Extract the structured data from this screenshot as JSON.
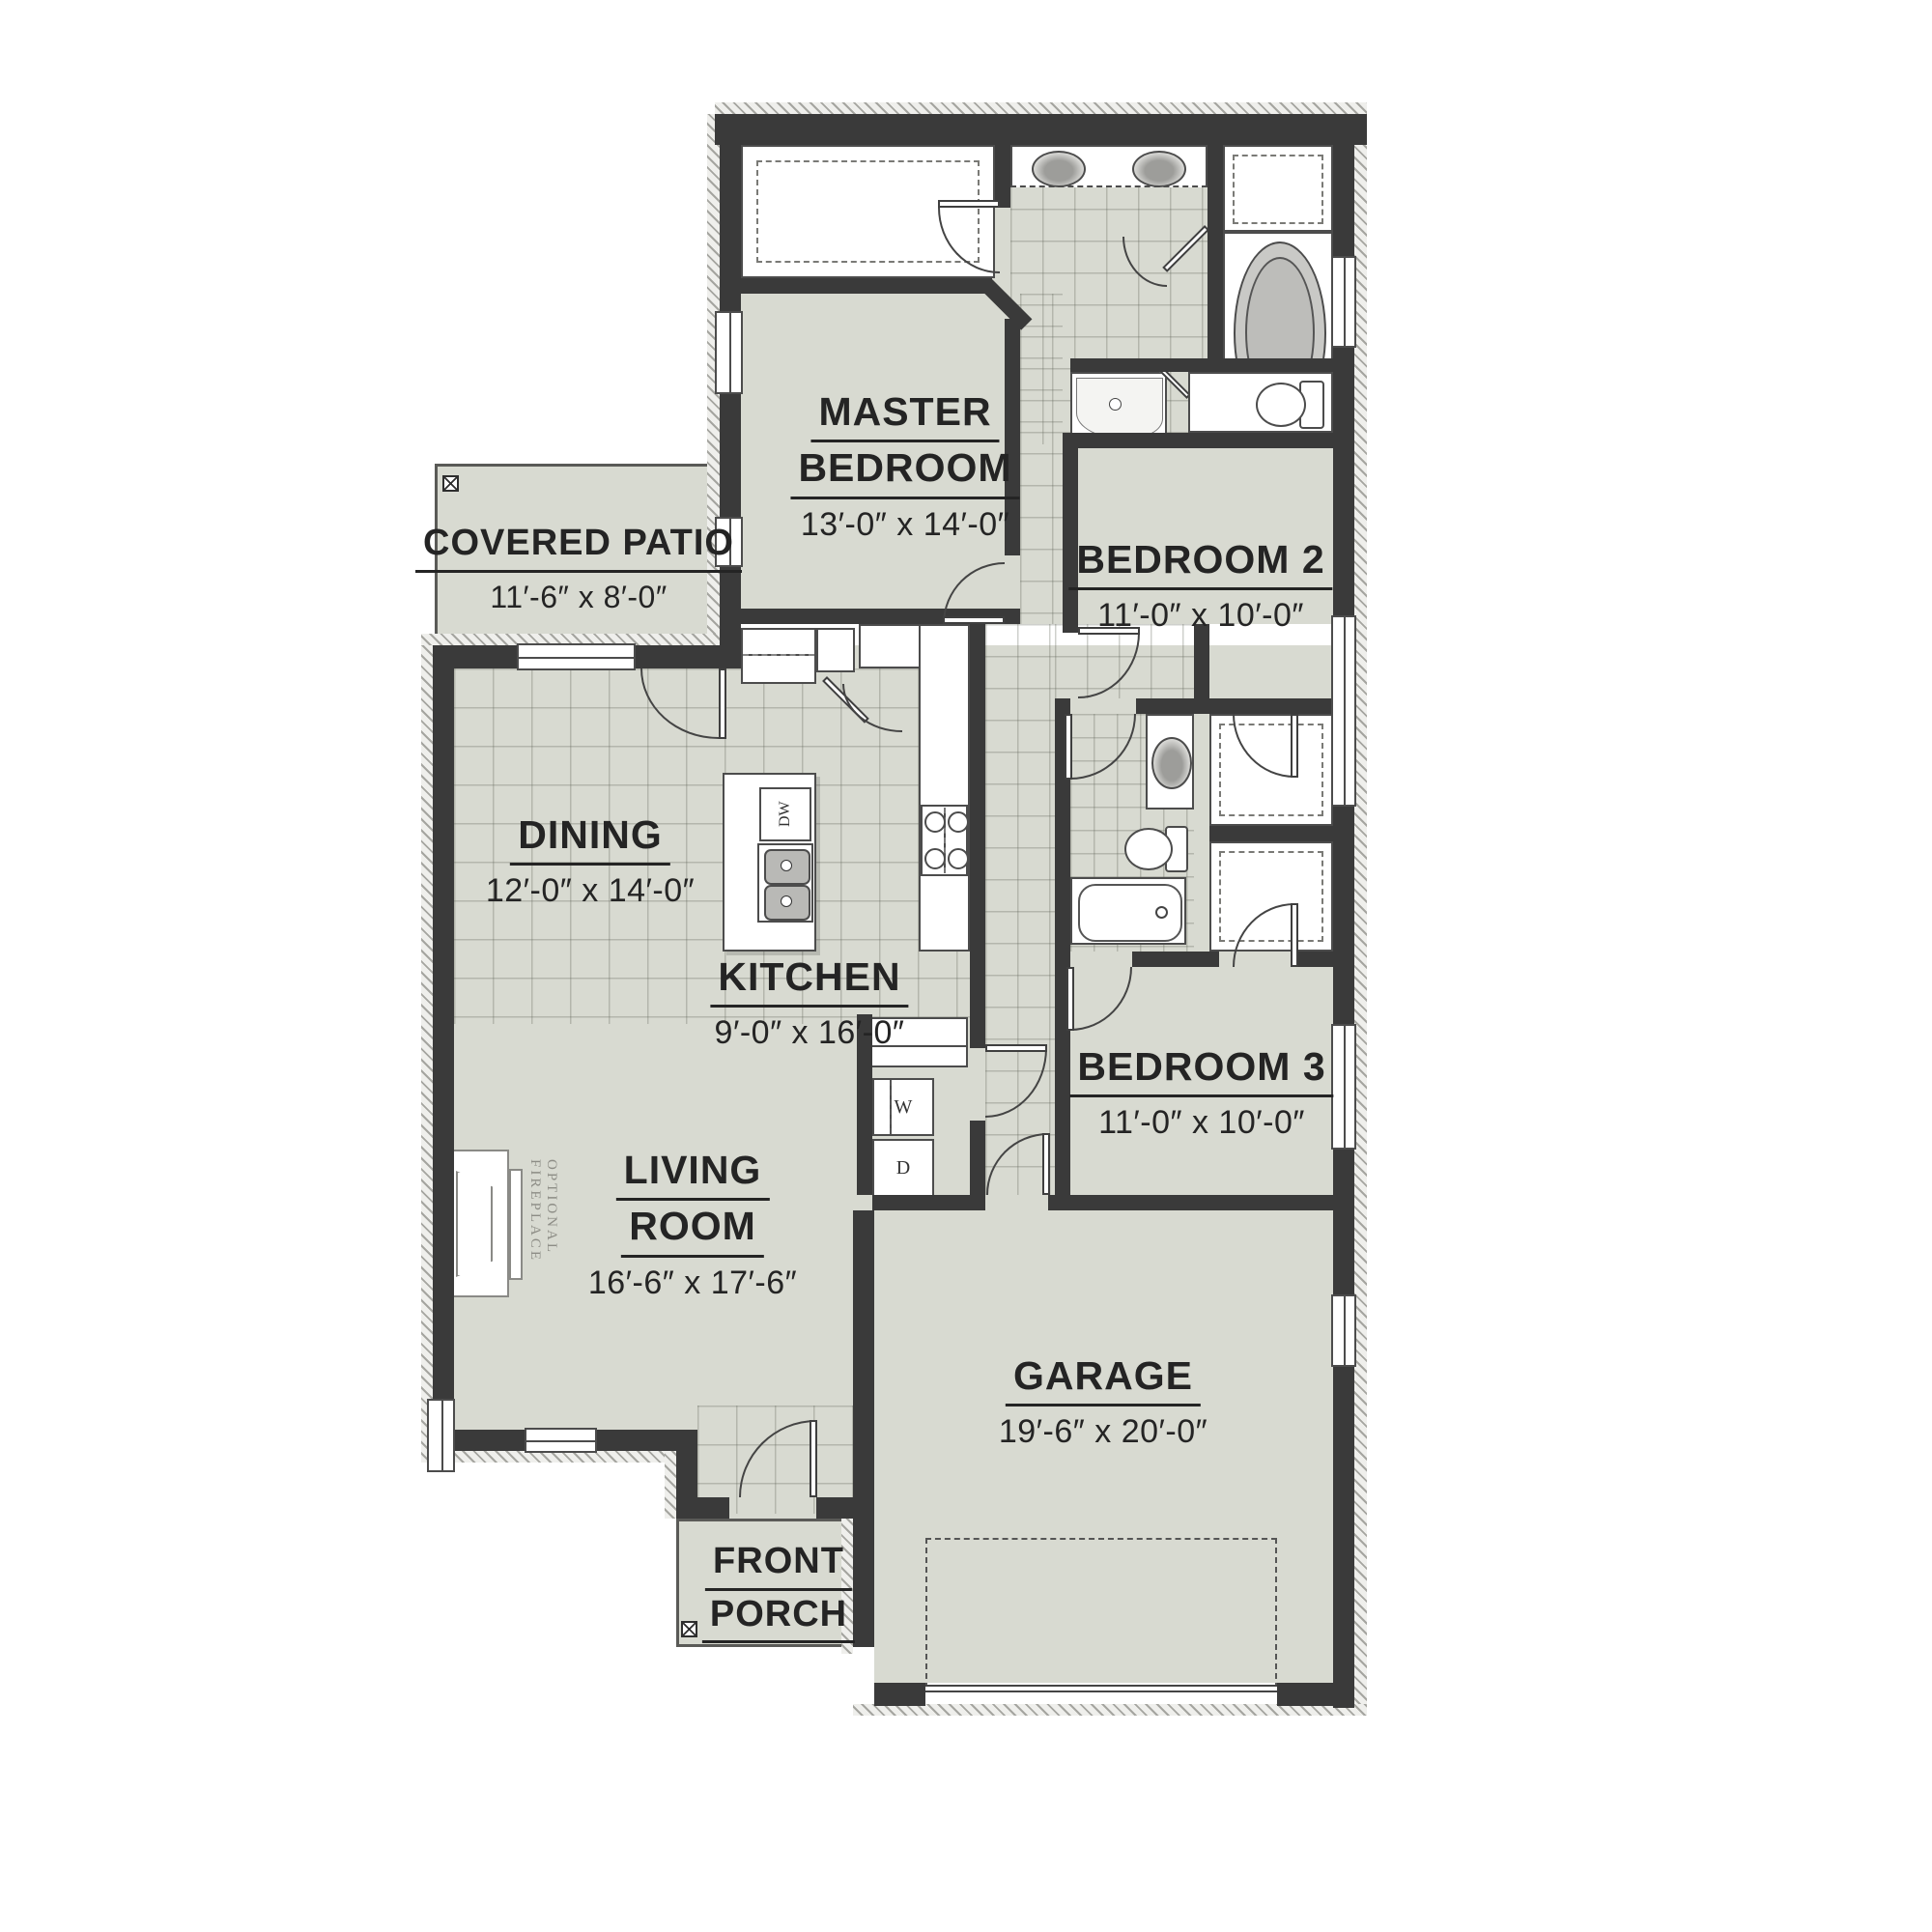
{
  "plan_title": "Single-story house floor plan",
  "colors": {
    "wall": "#3a3a3a",
    "floor": "#d8dad1",
    "fixture_white": "#ffffff",
    "text": "#242424",
    "hatch_line": "#a5a5a0"
  },
  "rooms": {
    "master": {
      "name_line1": "MASTER",
      "name_line2": "BEDROOM",
      "dims": "13′-0″ x 14′-0″"
    },
    "bedroom2": {
      "name": "BEDROOM 2",
      "dims": "11′-0″ x 10′-0″"
    },
    "bedroom3": {
      "name": "BEDROOM 3",
      "dims": "11′-0″ x 10′-0″"
    },
    "covered_patio": {
      "name": "COVERED PATIO",
      "dims": "11′-6″ x 8′-0″"
    },
    "dining": {
      "name": "DINING",
      "dims": "12′-0″ x 14′-0″"
    },
    "kitchen": {
      "name": "KITCHEN",
      "dims": "9′-0″ x 16′-0″"
    },
    "living": {
      "name_line1": "LIVING",
      "name_line2": "ROOM",
      "dims": "16′-6″ x 17′-6″"
    },
    "garage": {
      "name": "GARAGE",
      "dims": "19′-6″ x 20′-0″"
    },
    "front_porch": {
      "name_line1": "FRONT",
      "name_line2": "PORCH"
    }
  },
  "appliances": {
    "washer": "W",
    "dryer": "D",
    "dishwasher": "DW"
  },
  "annotations": {
    "fireplace": "OPTIONAL FIREPLACE"
  }
}
